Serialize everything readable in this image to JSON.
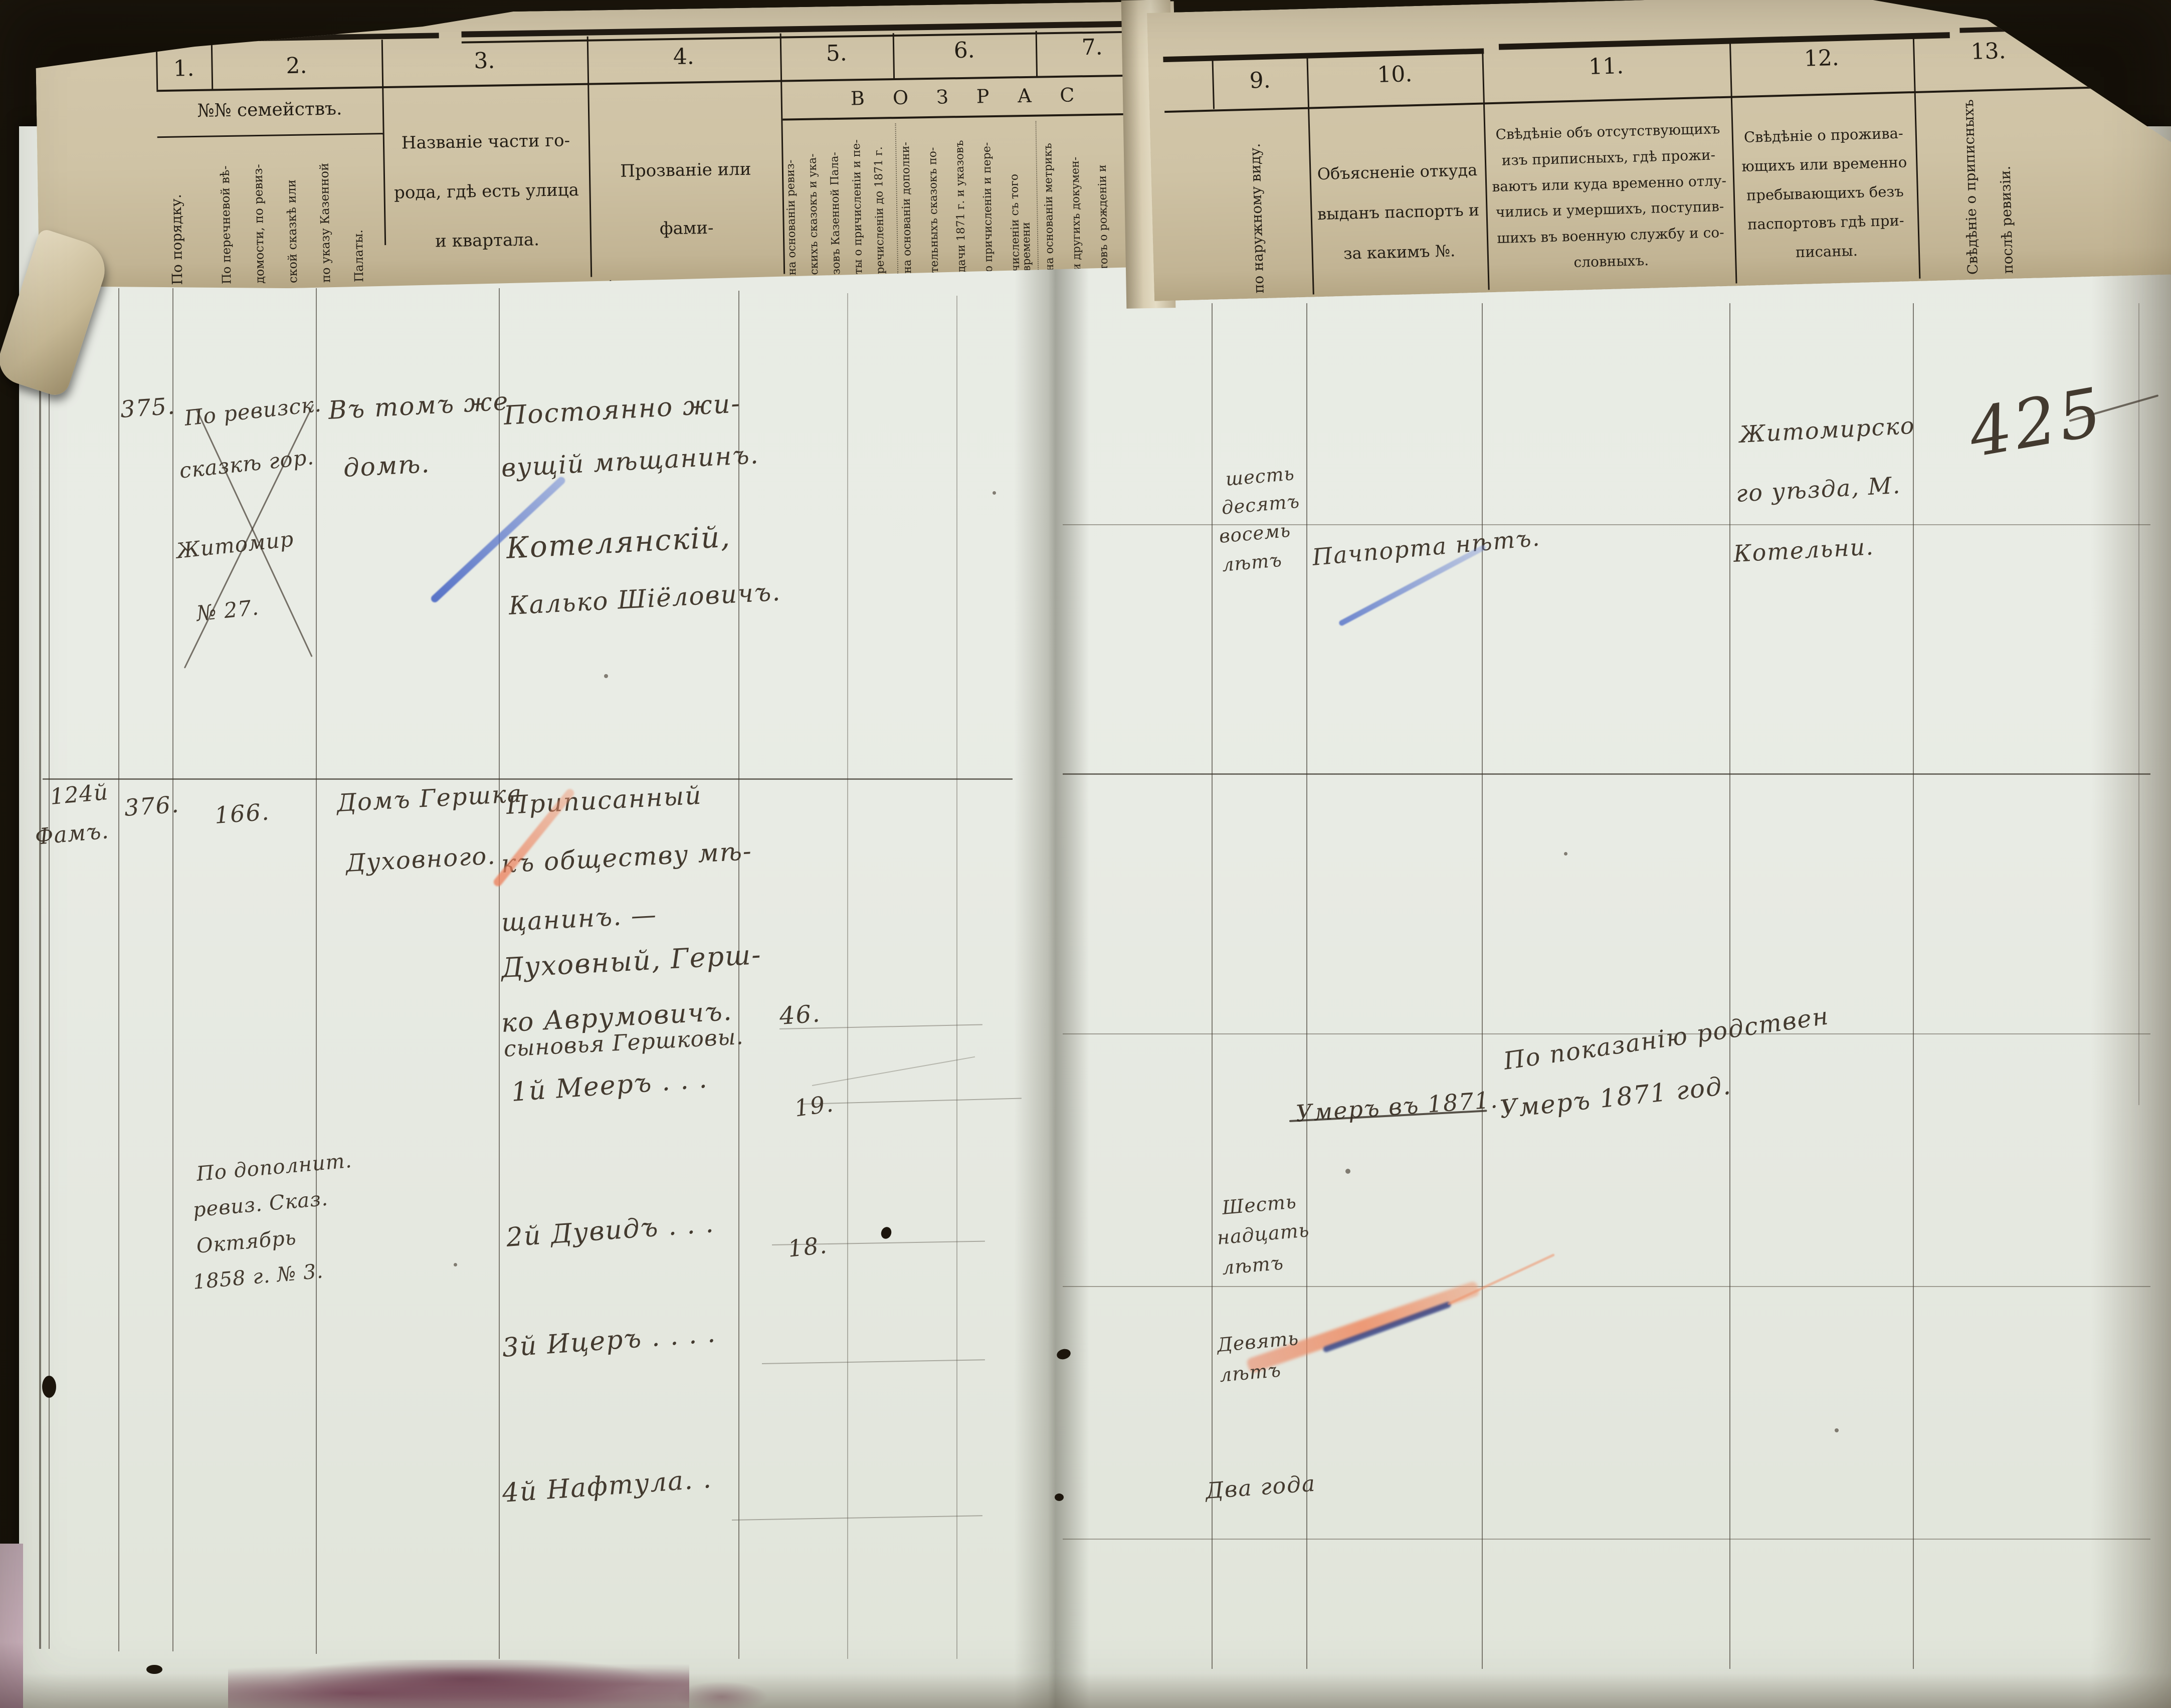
{
  "document": {
    "page_number": "425",
    "description": "Revision list ledger spread (Russian Empire, Zhytomyr), printed header with handwritten entries",
    "ink_color": "#433a2f",
    "pencil_blue": "#5d7fd0",
    "pencil_red": "#e2886a",
    "paper_main": "#e8ebe4",
    "paper_header": "#cfc3a5"
  },
  "header": {
    "cols12_label": "№№ семействъ.",
    "num1": "1.",
    "num2": "2.",
    "num3": "3.",
    "num4": "4.",
    "num5": "5.",
    "num6": "6.",
    "num7": "7.",
    "num9": "9.",
    "num10": "10.",
    "num11": "11.",
    "num12": "12.",
    "num13": "13.",
    "col1_vertical": "По порядку.",
    "col2_lines": [
      "По перечневой вѣ-",
      "домости, по ревиз-",
      "ской сказкѣ или",
      "по указу Казенной",
      "Палаты."
    ],
    "col3_lines": [
      "Названіе части го-",
      "рода, гдѣ есть улица",
      "и квартала."
    ],
    "col4_lines": [
      "Прозваніе или фами-",
      "лія, имя и отчество."
    ],
    "age_band": "В О З Р А С",
    "col5_lines": [
      "на основаніи ревиз-",
      "скихъ сказокъ и ука-",
      "зовъ Казенной Пала-",
      "ты о причисленіи и пе-",
      "речисленіи до 1871 г."
    ],
    "col6_lines": [
      "на основаніи дополни-",
      "тельныхъ сказокъ по-",
      "дачи 1871 г. и указовъ",
      "о причисленіи и пере-",
      "численіи съ того времени"
    ],
    "col7_lines": [
      "на основаніи метрикъ",
      "и другихъ докумен-",
      "товъ о рожденіи и",
      "личности евреевъ."
    ],
    "col9_vertical": "по наружному виду.",
    "col10_lines": [
      "Объясненіе откуда",
      "выданъ паспортъ и",
      "за какимъ №."
    ],
    "col11_lines": [
      "Свѣдѣніе объ отсутствующихъ",
      "изъ приписныхъ, гдѣ прожи-",
      "ваютъ или куда временно отлу-",
      "чились и умершихъ, поступив-",
      "шихъ въ военную службу и со-",
      "словныхъ."
    ],
    "col12_lines": [
      "Свѣдѣніе о прожива-",
      "ющихъ или временно",
      "пребывающихъ безъ",
      "паспортовъ гдѣ при-",
      "писаны."
    ],
    "col13_lines": [
      "Свѣдѣніе о приписныхъ",
      "послѣ ревизіи."
    ]
  },
  "record375": {
    "number": "375.",
    "crossed_ref_lines": [
      "По ревизск.",
      "сказкѣ гор.",
      "Житомир",
      "№ 27."
    ],
    "house_lines": [
      "Въ томъ же",
      "домѣ."
    ],
    "person_lines": [
      "Постоянно жи-",
      "вущій мѣщанинъ.",
      "Котелянскій,",
      "Калько Шіёловичъ."
    ],
    "age_lines": [
      "шесть",
      "десятъ",
      "восемь",
      "лѣтъ"
    ],
    "passport_note": "Пачпорта нѣтъ.",
    "residence_lines": [
      "Житомирско",
      "го уѣзда, М.",
      "Котельни."
    ]
  },
  "record376": {
    "margin_lines": [
      "124й",
      "Фамъ."
    ],
    "number": "376.",
    "family_number": "166.",
    "house_lines": [
      "Домъ Гершка",
      "Духовного."
    ],
    "person_lines": [
      "Приписанный",
      "къ обществу мѣ-",
      "щанинъ. —",
      "Духовный, Герш-",
      "ко Аврумовичъ."
    ],
    "head_age": "46.",
    "sons_label": "сыновья Гершковы.",
    "son1": "1й Мееръ . . .",
    "son1_age": "19.",
    "son2": "2й Дувидъ . . .",
    "son2_age": "18.",
    "son3": "3й Ицеръ . . . .",
    "son4": "4й Нафтула. .",
    "note_lines": [
      "По дополнит.",
      "ревиз. Сказ.",
      "Октябрь",
      "1858 г. № 3."
    ],
    "son1_age_words": [
      "Шесть",
      "надцать",
      "лѣтъ"
    ],
    "son2_age_words": [
      "Девять",
      "лѣтъ"
    ],
    "son3_age_words": "Два года",
    "death_witness": "По показанію родствен",
    "death_crossed": "Умеръ въ 1871.",
    "death_note": "Умеръ 1871 год."
  }
}
